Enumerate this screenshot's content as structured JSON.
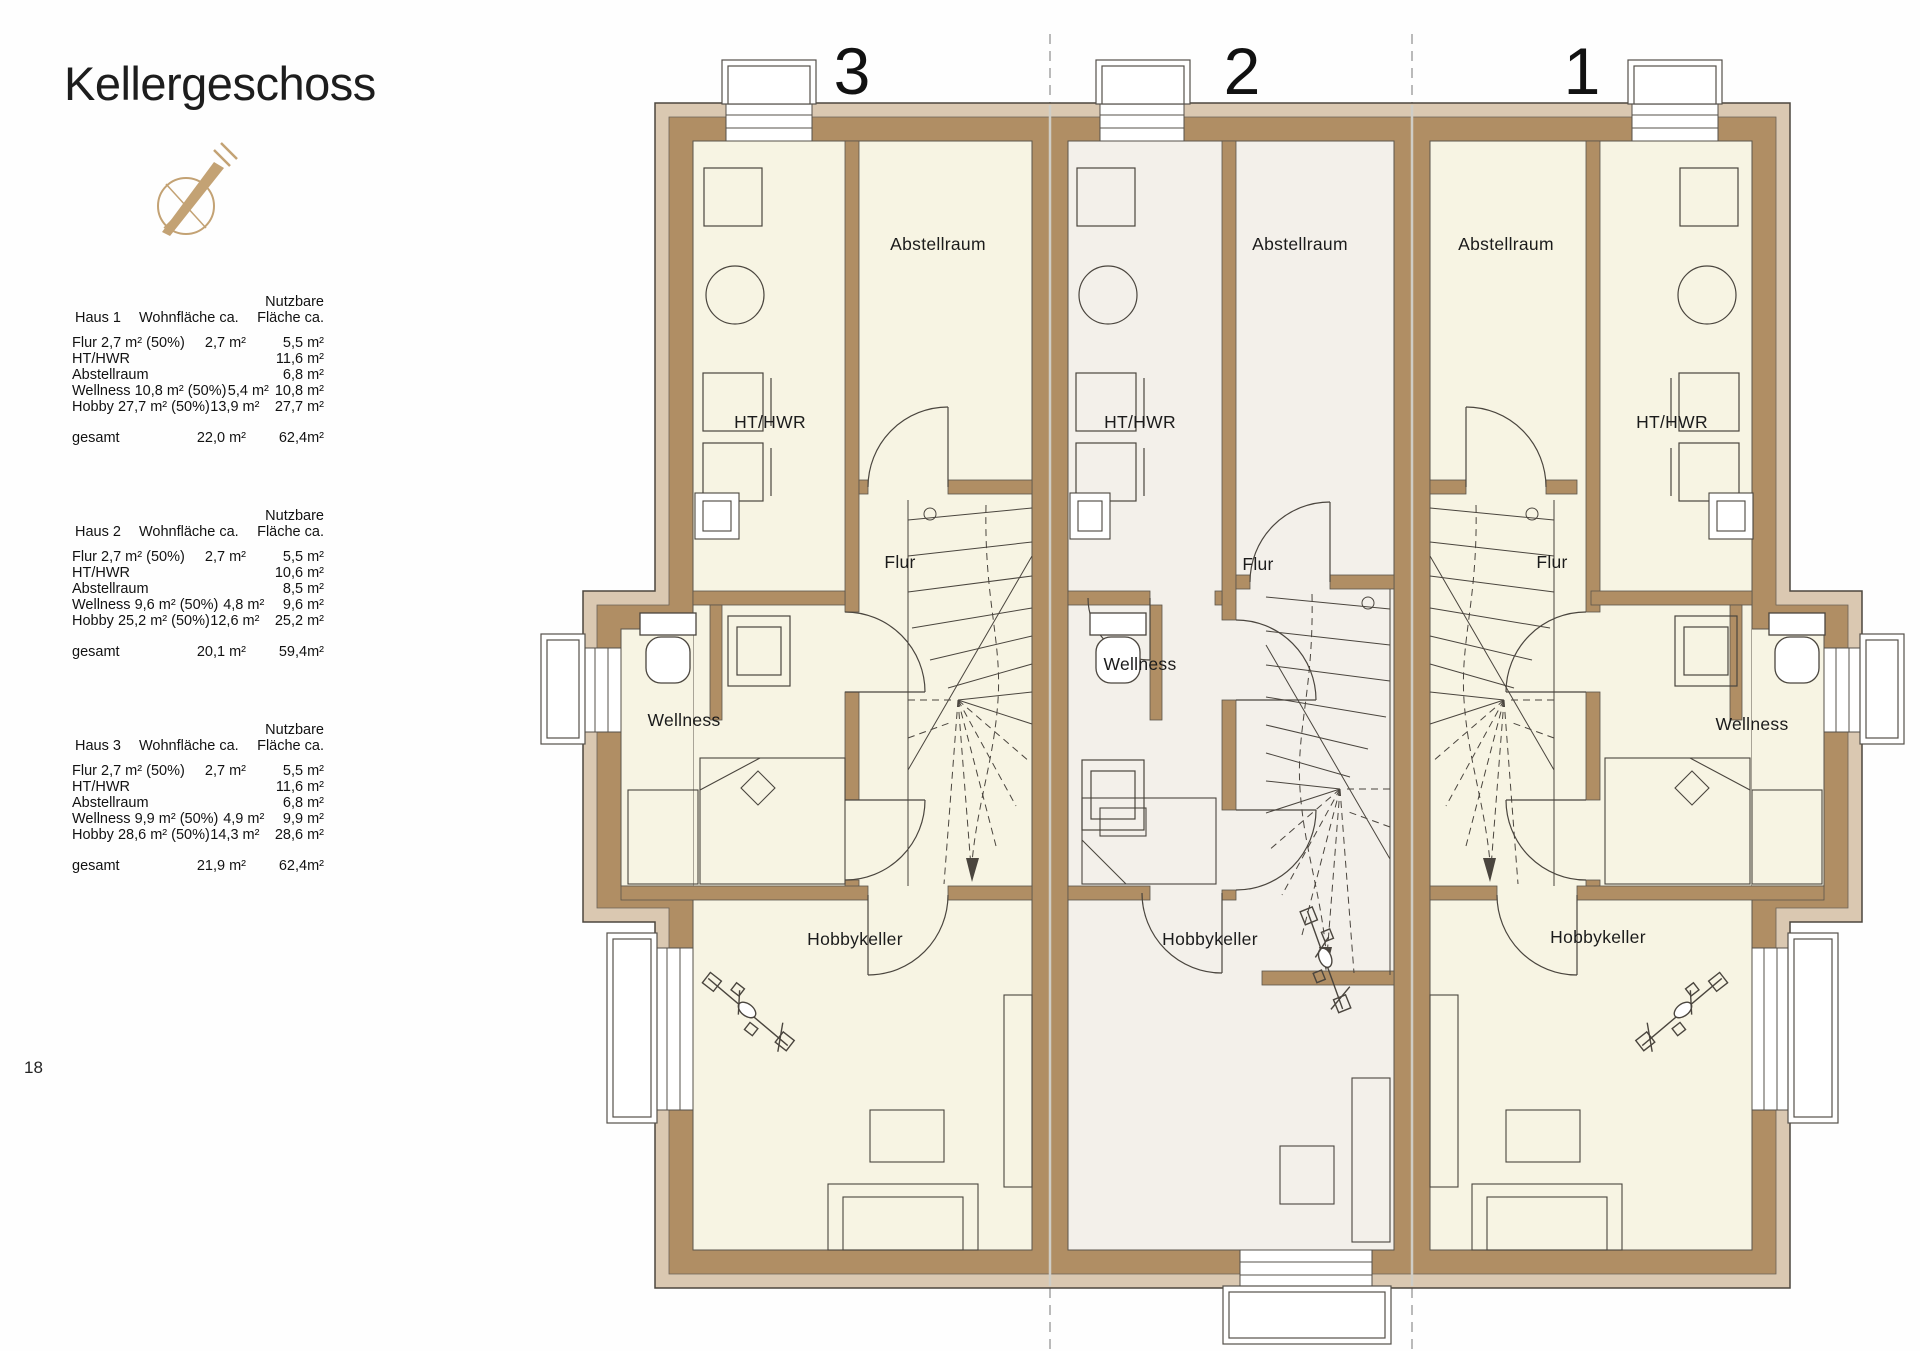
{
  "page": {
    "title": "Kellergeschoss",
    "page_number": "18"
  },
  "tables": [
    {
      "house": "Haus 1",
      "col_wohn": "Wohnfläche ca.",
      "col_nutz1": "Nutzbare",
      "col_nutz2": "Fläche ca.",
      "rows": [
        {
          "label": "Flur 2,7 m²  (50%)",
          "wohn": "2,7 m²",
          "nutz": "5,5 m²"
        },
        {
          "label": "HT/HWR",
          "wohn": "",
          "nutz": "11,6 m²"
        },
        {
          "label": "Abstellraum",
          "wohn": "",
          "nutz": "6,8 m²"
        },
        {
          "label": "Wellness 10,8 m²  (50%)",
          "wohn": "5,4 m²",
          "nutz": "10,8 m²"
        },
        {
          "label": "Hobby 27,7 m²  (50%)",
          "wohn": "13,9 m²",
          "nutz": "27,7 m²"
        }
      ],
      "total": {
        "label": "gesamt",
        "wohn": "22,0 m²",
        "nutz": "62,4m²"
      }
    },
    {
      "house": "Haus 2",
      "col_wohn": "Wohnfläche ca.",
      "col_nutz1": "Nutzbare",
      "col_nutz2": "Fläche ca.",
      "rows": [
        {
          "label": "Flur 2,7 m²  (50%)",
          "wohn": "2,7 m²",
          "nutz": "5,5 m²"
        },
        {
          "label": "HT/HWR",
          "wohn": "",
          "nutz": "10,6 m²"
        },
        {
          "label": "Abstellraum",
          "wohn": "",
          "nutz": "8,5 m²"
        },
        {
          "label": "Wellness 9,6 m²  (50%)",
          "wohn": "4,8 m²",
          "nutz": "9,6 m²"
        },
        {
          "label": "Hobby 25,2 m²  (50%)",
          "wohn": "12,6 m²",
          "nutz": "25,2 m²"
        }
      ],
      "total": {
        "label": "gesamt",
        "wohn": "20,1 m²",
        "nutz": "59,4m²"
      }
    },
    {
      "house": "Haus 3",
      "col_wohn": "Wohnfläche ca.",
      "col_nutz1": "Nutzbare",
      "col_nutz2": "Fläche ca.",
      "rows": [
        {
          "label": "Flur 2,7 m²  (50%)",
          "wohn": "2,7 m²",
          "nutz": "5,5 m²"
        },
        {
          "label": "HT/HWR",
          "wohn": "",
          "nutz": "11,6 m²"
        },
        {
          "label": "Abstellraum",
          "wohn": "",
          "nutz": "6,8 m²"
        },
        {
          "label": "Wellness 9,9 m²  (50%)",
          "wohn": "4,9 m²",
          "nutz": "9,9 m²"
        },
        {
          "label": "Hobby 28,6 m²  (50%)",
          "wohn": "14,3 m²",
          "nutz": "28,6 m²"
        }
      ],
      "total": {
        "label": "gesamt",
        "wohn": "21,9 m²",
        "nutz": "62,4m²"
      }
    }
  ],
  "plan": {
    "house_numbers": {
      "left": "3",
      "middle": "2",
      "right": "1"
    },
    "haus3": {
      "ht_hwr": "HT/HWR",
      "abstellraum": "Abstellraum",
      "flur": "Flur",
      "wellness": "Wellness",
      "hobbykeller": "Hobbykeller"
    },
    "haus2": {
      "ht_hwr": "HT/HWR",
      "abstellraum": "Abstellraum",
      "flur": "Flur",
      "wellness": "Wellness",
      "hobbykeller": "Hobbykeller"
    },
    "haus1": {
      "ht_hwr": "HT/HWR",
      "abstellraum": "Abstellraum",
      "flur": "Flur",
      "wellness": "Wellness",
      "hobbykeller": "Hobbykeller"
    }
  },
  "colors": {
    "wall_dark": "#b08e64",
    "wall_light": "#dac8b1",
    "room_cream": "#f7f4e3",
    "room_white": "#f3f0ea",
    "outline": "#4c463e",
    "compass": "#c3a274"
  }
}
